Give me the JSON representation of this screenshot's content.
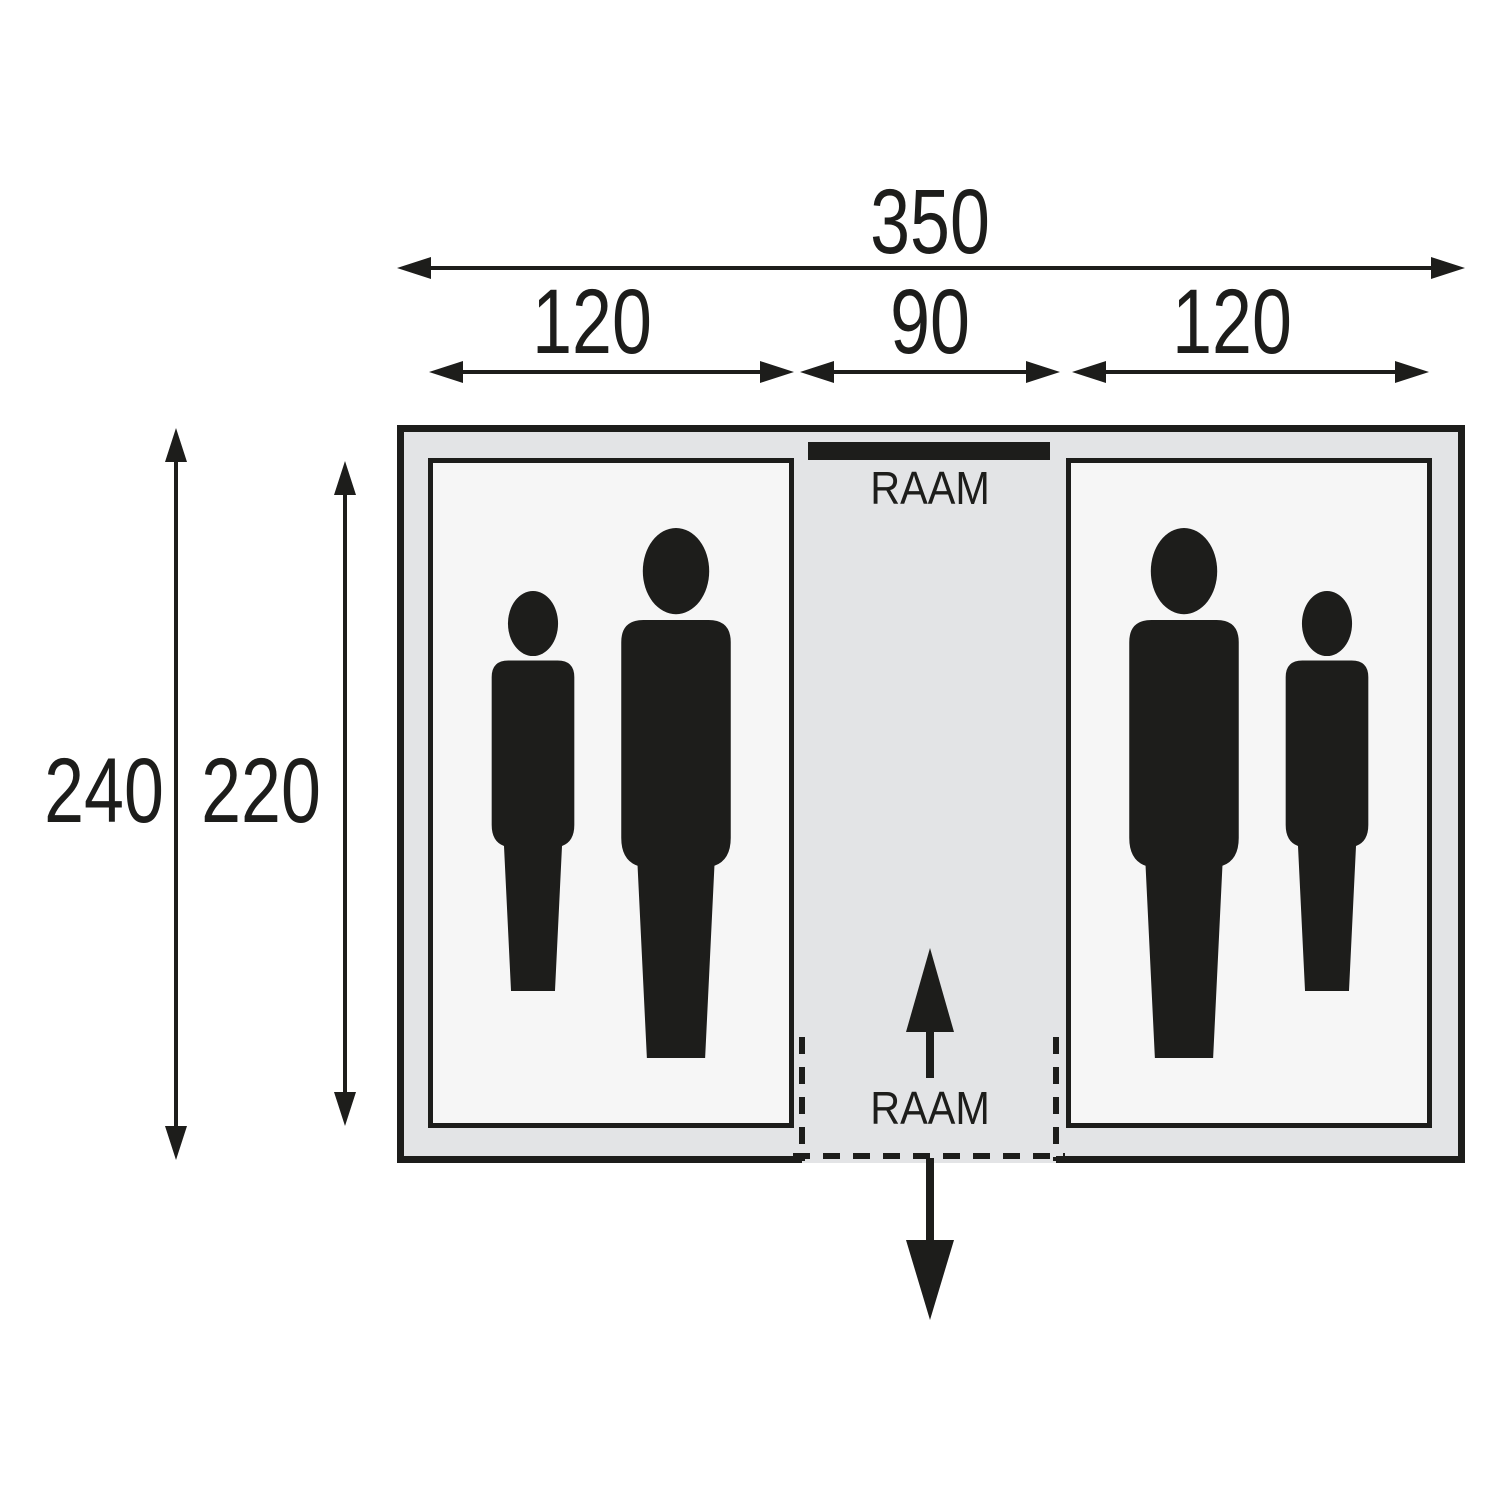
{
  "diagram_title": "tent-floorplan",
  "colors": {
    "background": "#ffffff",
    "outline": "#1d1d1b",
    "plan_fill": "#e3e4e6",
    "compartment_fill": "#f6f6f6",
    "figure_fill": "#1d1d1b",
    "window_bar": "#1d1d1b"
  },
  "dimensions": {
    "total_width": "350",
    "left_compartment_width": "120",
    "center_corridor_width": "90",
    "right_compartment_width": "120",
    "outer_depth": "240",
    "inner_depth": "220"
  },
  "labels": {
    "window_top": "RAAM",
    "window_bottom": "RAAM"
  }
}
